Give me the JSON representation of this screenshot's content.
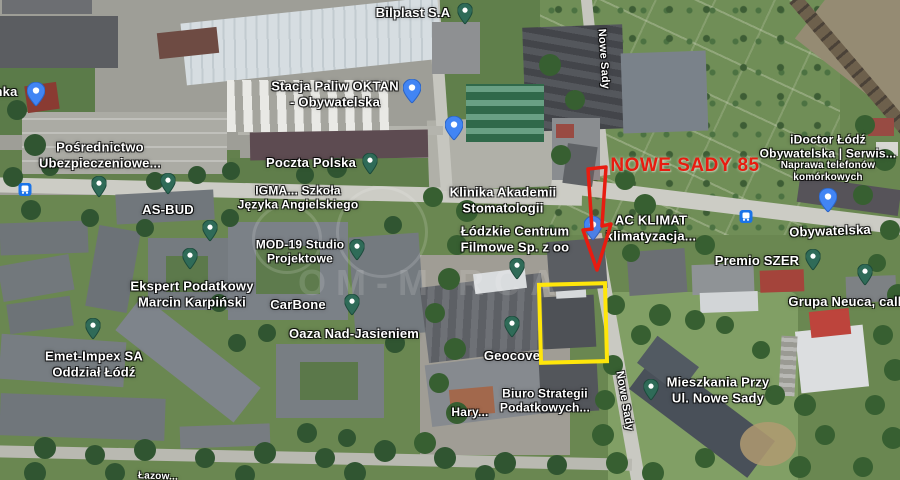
{
  "map": {
    "annotations": {
      "label": "NOWE SADY 85",
      "label_color": "#e81c10",
      "arrow_color": "#e81c10",
      "box_color": "#ffe60a"
    },
    "watermark": {
      "text": "OM-M RCA"
    },
    "labels": [
      {
        "id": "bilplast",
        "kind": "place",
        "lines": [
          "Bilplast S.A"
        ],
        "x": 413,
        "y": 13,
        "fs": 13
      },
      {
        "id": "stacja-paliw-oktan",
        "kind": "place",
        "lines": [
          "Stacja Paliw OKTAN",
          "- Obywatelska"
        ],
        "x": 335,
        "y": 94,
        "fs": 13
      },
      {
        "id": "nka-partial",
        "kind": "place",
        "lines": [
          "nka"
        ],
        "x": 6,
        "y": 92,
        "fs": 13
      },
      {
        "id": "posrednictwo",
        "kind": "place",
        "lines": [
          "Pośrednictwo",
          "Ubezpieczeniowe..."
        ],
        "x": 100,
        "y": 155,
        "fs": 13
      },
      {
        "id": "poczta-polska",
        "kind": "place",
        "lines": [
          "Poczta Polska"
        ],
        "x": 311,
        "y": 163,
        "fs": 13
      },
      {
        "id": "as-bud",
        "kind": "place",
        "lines": [
          "AS-BUD"
        ],
        "x": 168,
        "y": 210,
        "fs": 13
      },
      {
        "id": "igma-szkola",
        "kind": "place",
        "lines": [
          "IGMA... Szkoła",
          "Języka Angielskiego"
        ],
        "x": 298,
        "y": 198,
        "fs": 12
      },
      {
        "id": "klinika",
        "kind": "place",
        "lines": [
          "Klinika Akademii",
          "Stomatologii"
        ],
        "x": 503,
        "y": 200,
        "fs": 13
      },
      {
        "id": "mod-19",
        "kind": "place",
        "lines": [
          "MOD-19 Studio",
          "Projektowe"
        ],
        "x": 300,
        "y": 252,
        "fs": 12
      },
      {
        "id": "lodzkie-centrum",
        "kind": "place",
        "lines": [
          "Łódzkie Centrum",
          "Filmowe Sp. z oo"
        ],
        "x": 515,
        "y": 239,
        "fs": 13
      },
      {
        "id": "ac-klimat",
        "kind": "place",
        "lines": [
          "AC KLIMAT",
          "klimatyzacja..."
        ],
        "x": 651,
        "y": 228,
        "fs": 13
      },
      {
        "id": "idoctor-name",
        "kind": "place",
        "lines": [
          "iDoctor Łódź",
          "Obywatelska | Serwis..."
        ],
        "x": 828,
        "y": 147,
        "fs": 12
      },
      {
        "id": "idoctor-sub",
        "kind": "place",
        "lines": [
          "Naprawa telefonów",
          "komórkowych"
        ],
        "x": 828,
        "y": 172,
        "fs": 10
      },
      {
        "id": "obywatelska-street",
        "kind": "street",
        "lines": [
          "Obywatelska"
        ],
        "x": 830,
        "y": 231,
        "fs": 13,
        "rot": -2
      },
      {
        "id": "premio-szer",
        "kind": "place",
        "lines": [
          "Premio SZER"
        ],
        "x": 757,
        "y": 261,
        "fs": 13
      },
      {
        "id": "grupa-neuca",
        "kind": "place",
        "lines": [
          "Grupa Neuca, call"
        ],
        "x": 845,
        "y": 302,
        "fs": 13
      },
      {
        "id": "ekspert-podatkowy",
        "kind": "place",
        "lines": [
          "Ekspert Podatkowy",
          "Marcin Karpiński"
        ],
        "x": 192,
        "y": 294,
        "fs": 13
      },
      {
        "id": "carbone",
        "kind": "place",
        "lines": [
          "CarBone"
        ],
        "x": 298,
        "y": 305,
        "fs": 13
      },
      {
        "id": "oaza",
        "kind": "place",
        "lines": [
          "Oaza Nad-Jasieniem"
        ],
        "x": 354,
        "y": 334,
        "fs": 13
      },
      {
        "id": "emet-impex",
        "kind": "place",
        "lines": [
          "Emet-Impex SA",
          "Oddział Łódź"
        ],
        "x": 94,
        "y": 364,
        "fs": 13
      },
      {
        "id": "geocove",
        "kind": "place",
        "lines": [
          "Geocove"
        ],
        "x": 512,
        "y": 356,
        "fs": 13
      },
      {
        "id": "biuro-strategii",
        "kind": "place",
        "lines": [
          "Biuro Strategii",
          "Podatkowych..."
        ],
        "x": 545,
        "y": 401,
        "fs": 12
      },
      {
        "id": "hary",
        "kind": "place",
        "lines": [
          "Hary..."
        ],
        "x": 470,
        "y": 412,
        "fs": 12
      },
      {
        "id": "mieszkania",
        "kind": "place",
        "lines": [
          "Mieszkania Przy",
          "Ul. Nowe Sady"
        ],
        "x": 718,
        "y": 390,
        "fs": 13
      },
      {
        "id": "nowe-sady-top",
        "kind": "street",
        "lines": [
          "Nowe Sady"
        ],
        "x": 603,
        "y": 59,
        "fs": 11,
        "rot": 86
      },
      {
        "id": "nowe-sady-bottom",
        "kind": "street",
        "lines": [
          "Nowe Sady"
        ],
        "x": 624,
        "y": 401,
        "fs": 11,
        "rot": 80
      },
      {
        "id": "lazow-partial",
        "kind": "street",
        "lines": [
          "Łazow..."
        ],
        "x": 158,
        "y": 477,
        "fs": 10,
        "rot": 2
      }
    ],
    "pins": [
      {
        "id": "bilplast",
        "type": "place",
        "icon": "factory-icon",
        "x": 465,
        "y": 12
      },
      {
        "id": "poczta-polska",
        "type": "place",
        "icon": "mail-icon",
        "x": 370,
        "y": 162
      },
      {
        "id": "road-west",
        "type": "place",
        "icon": "place-icon",
        "x": 99,
        "y": 185
      },
      {
        "id": "as-bud",
        "type": "place",
        "icon": "place-icon",
        "x": 168,
        "y": 182
      },
      {
        "id": "igma",
        "type": "place",
        "icon": "place-icon",
        "x": 210,
        "y": 229
      },
      {
        "id": "mod-19",
        "type": "place",
        "icon": "place-icon",
        "x": 357,
        "y": 248
      },
      {
        "id": "ekspert",
        "type": "place",
        "icon": "place-icon",
        "x": 190,
        "y": 257
      },
      {
        "id": "filmowe",
        "type": "place",
        "icon": "place-icon",
        "x": 517,
        "y": 267
      },
      {
        "id": "carbone",
        "type": "place",
        "icon": "place-icon",
        "x": 352,
        "y": 303
      },
      {
        "id": "emet-impex",
        "type": "place",
        "icon": "place-icon",
        "x": 93,
        "y": 327
      },
      {
        "id": "geocove",
        "type": "place",
        "icon": "place-icon",
        "x": 512,
        "y": 325
      },
      {
        "id": "mieszkania",
        "type": "place",
        "icon": "place-icon",
        "x": 651,
        "y": 388
      },
      {
        "id": "premio",
        "type": "place",
        "icon": "place-icon",
        "x": 813,
        "y": 258
      },
      {
        "id": "neuca",
        "type": "place",
        "icon": "place-icon",
        "x": 865,
        "y": 273
      },
      {
        "id": "nka-poi",
        "type": "poi-blue",
        "icon": "building-icon",
        "x": 36,
        "y": 92
      },
      {
        "id": "fuel-station",
        "type": "poi-blue",
        "icon": "fuel-icon",
        "x": 412,
        "y": 89
      },
      {
        "id": "hotel",
        "type": "poi-blue",
        "icon": "bed-icon",
        "x": 454,
        "y": 126
      },
      {
        "id": "shopping",
        "type": "poi-blue",
        "icon": "shopping-bag-icon",
        "x": 828,
        "y": 198
      },
      {
        "id": "ac-klimat",
        "type": "poi-blue",
        "icon": "fan-icon",
        "x": 593,
        "y": 226
      },
      {
        "id": "bus-stop-west",
        "type": "transit",
        "icon": "bus-icon",
        "x": 25,
        "y": 192
      },
      {
        "id": "bus-stop-obywatelska",
        "type": "transit",
        "icon": "bus-icon",
        "x": 746,
        "y": 219
      }
    ]
  }
}
